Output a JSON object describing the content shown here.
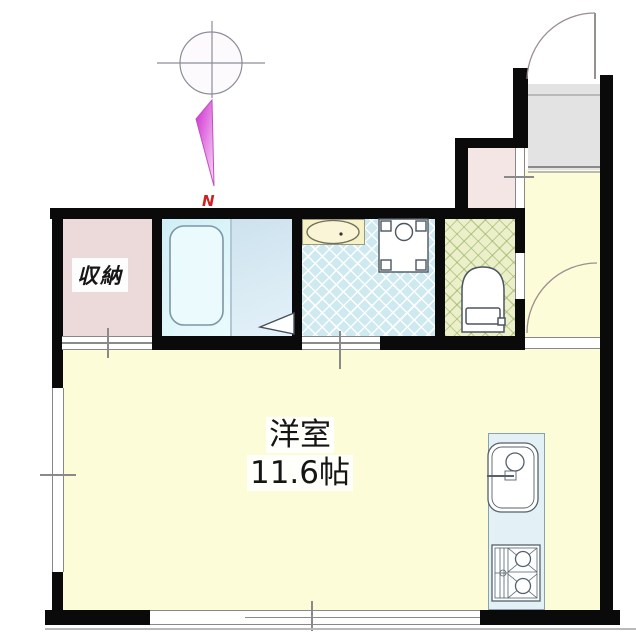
{
  "labels": {
    "storage": "収納",
    "main_room_name": "洋室",
    "main_room_size": "11.6帖",
    "north": "N"
  },
  "colors": {
    "wall": "#0a0a0a",
    "room_yellow": "#fdfcd8",
    "storage_pink": "#ecdada",
    "closet_pink": "#f5e6e6",
    "washroom_cyan": "#cfe9f0",
    "toilet_green": "#ebf0ca",
    "entrance_gray": "#e3e3e3",
    "kitchen_blue": "#e3f1f7",
    "counter_cream": "#f7f1c6",
    "line_gray": "#8a8a8a",
    "north_red": "#cc2222",
    "arrow_magenta": "#d935d9"
  },
  "icons": [
    "compass-icon",
    "north-arrow-icon",
    "bathtub-icon",
    "door-swing-triangle-icon",
    "washbasin-icon",
    "washing-machine-pan-icon",
    "toilet-icon",
    "kitchen-sink-icon",
    "gas-stove-icon",
    "entrance-door-arc",
    "room-door-arc",
    "window-symbol",
    "sliding-door-symbol"
  ]
}
